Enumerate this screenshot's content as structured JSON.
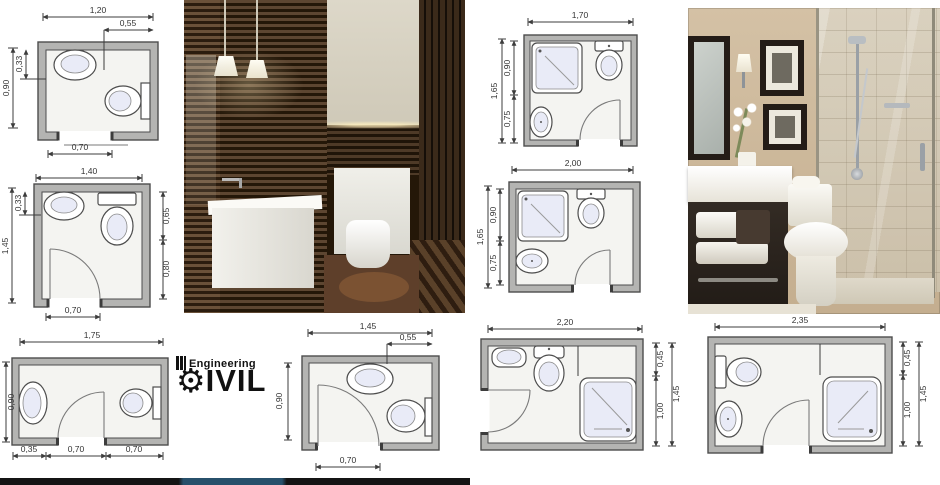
{
  "brand": {
    "top_text": "Engineering",
    "name": "CIVIL",
    "name_rest": "IVIL"
  },
  "plans": {
    "p1": {
      "width": "1,20",
      "inner_width": "0,55",
      "height": "0,90",
      "inner_height": "0,33",
      "door": "0,70"
    },
    "p2": {
      "width": "1,40",
      "height": "1,45",
      "inner_height": "0,33",
      "right_top": "0,65",
      "right_bottom": "0,80",
      "door": "0,70"
    },
    "p3": {
      "width": "1,75",
      "height": "0,90",
      "seg1": "0,35",
      "seg2": "0,70",
      "seg3": "0,70"
    },
    "p4": {
      "width": "1,45",
      "inner_width": "0,55",
      "height": "0,90",
      "door": "0,70"
    },
    "p5": {
      "width": "1,70",
      "height": "1,65",
      "top_zone": "0,90",
      "bottom_zone": "0,75"
    },
    "p6": {
      "width": "2,00",
      "height": "1,65",
      "top_zone": "0,90",
      "bottom_zone": "0,75"
    },
    "p7": {
      "width": "2,20",
      "height": "1,45",
      "top_zone": "0,45",
      "bottom_zone": "1,00"
    },
    "p8": {
      "width": "2,35",
      "height": "1,45",
      "top_zone": "0,45",
      "bottom_zone": "1,00"
    }
  },
  "colors": {
    "plan_wall": "#b4b4b2",
    "plan_floor": "#f4f4f1",
    "fixture_fill": "#e9ebf7",
    "dim_line": "#3c3c3c",
    "wood_dark": "#241708",
    "wood_light": "#5d4631",
    "beige_wall": "#cfbb9e",
    "banner_blue": "#27506b",
    "banner_black": "#141414"
  }
}
